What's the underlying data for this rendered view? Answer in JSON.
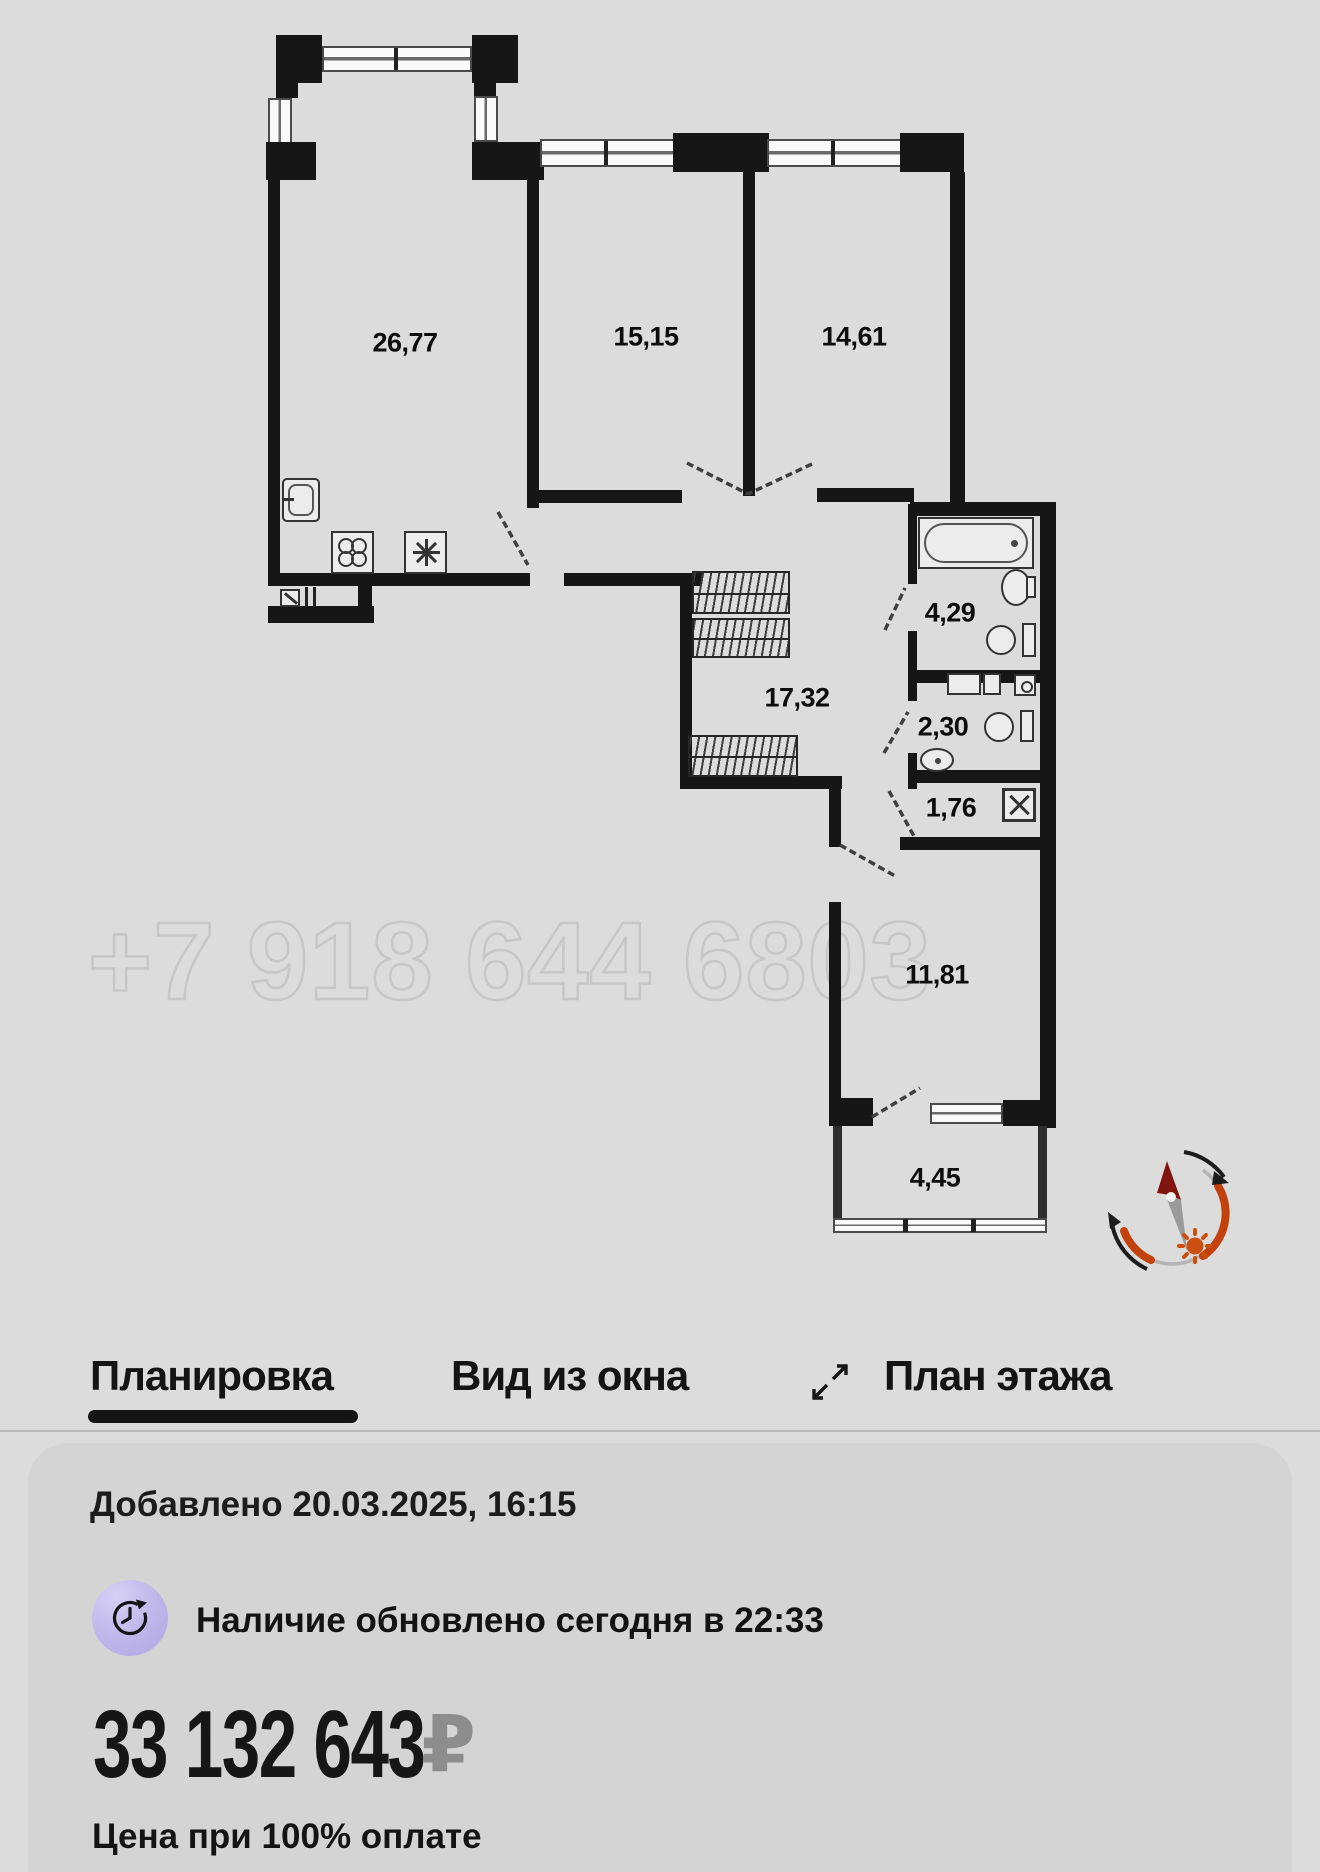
{
  "floor_plan": {
    "watermark": "+7 918 644 6803",
    "room_labels": [
      {
        "name": "living-kitchen",
        "area": "26,77"
      },
      {
        "name": "bedroom-1",
        "area": "15,15"
      },
      {
        "name": "bedroom-2",
        "area": "14,61"
      },
      {
        "name": "bathroom",
        "area": "4,29"
      },
      {
        "name": "corridor",
        "area": "17,32"
      },
      {
        "name": "wc",
        "area": "2,30"
      },
      {
        "name": "storage",
        "area": "1,76"
      },
      {
        "name": "hallway",
        "area": "11,81"
      },
      {
        "name": "balcony",
        "area": "4,45"
      }
    ]
  },
  "tabs": {
    "items": [
      {
        "label": "Планировка",
        "active": true
      },
      {
        "label": "Вид из окна",
        "active": false
      },
      {
        "label": "План этажа",
        "active": false,
        "icon": "expand-icon"
      }
    ]
  },
  "listing_card": {
    "added": "Добавлено 20.03.2025, 16:15",
    "availability": "Наличие обновлено сегодня в 22:33",
    "availability_icon": "clock-refresh-icon",
    "price": "33 132 643",
    "currency_symbol": "₽",
    "price_note": "Цена при 100% оплате"
  },
  "colors": {
    "page_bg": "#dcdcdc",
    "card_bg": "#d4d4d4",
    "wall": "#161616",
    "watermark_outline": "#c7c7c7",
    "compass_orange": "#c2410c",
    "compass_arrow_red": "#7f150e",
    "currency_gray": "#8d8d8d"
  }
}
